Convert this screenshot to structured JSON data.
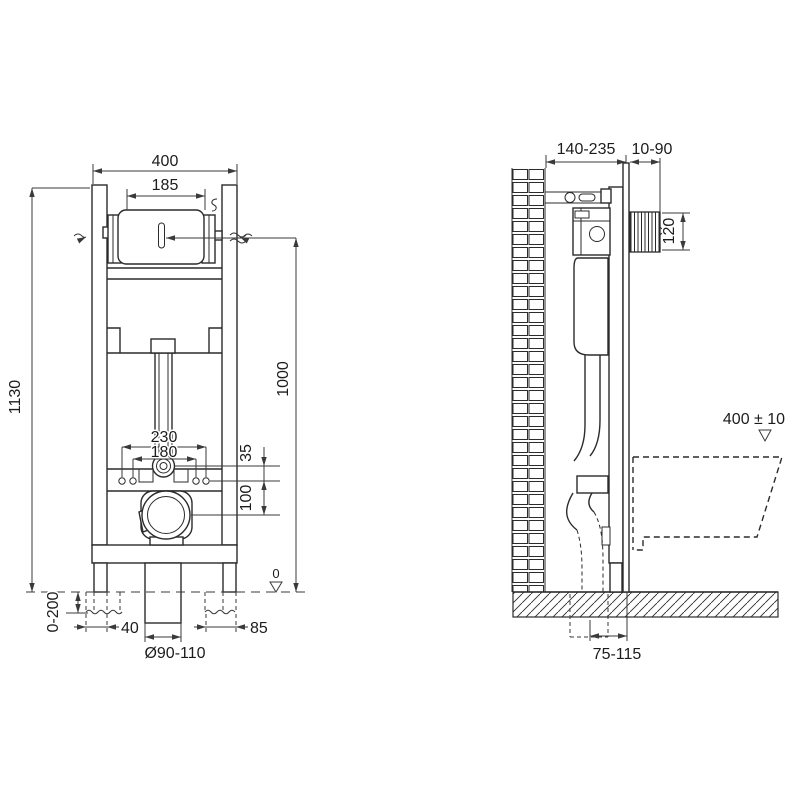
{
  "drawing_title": "wall-hung-wc-installation-frame-dimensional-drawing",
  "colors": {
    "background": "#ffffff",
    "line": "#2b2b2b",
    "dimension_line": "#3a3a3a",
    "text": "#1c1c1c"
  },
  "front_view": {
    "label": "front-view",
    "dim_frame_width": "400",
    "dim_cistern_width": "185",
    "dim_frame_height": "1130",
    "dim_flush_pipe_height": "1000",
    "dim_fixing_spacing_outer": "230",
    "dim_fixing_spacing_inner": "180",
    "dim_elbow_to_plate": "35",
    "dim_plate_to_outlet": "100",
    "dim_leg_adjustment": "0-200",
    "dim_left_offset": "40",
    "dim_drain_diameter": "Ø90-110",
    "dim_right_offset": "85",
    "datum_floor_zero": "0"
  },
  "side_view": {
    "label": "side-view",
    "dim_frame_depth": "140-235",
    "dim_wall_finish_depth": "10-90",
    "dim_access_opening": "120",
    "dim_bowl_rim_height": "400 ± 10",
    "dim_outlet_axis_to_wall": "75-115"
  }
}
